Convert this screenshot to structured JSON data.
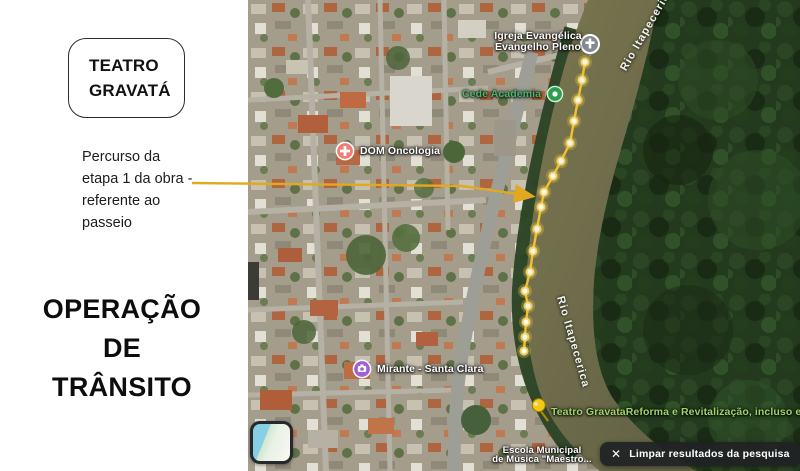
{
  "slide": {
    "badge_label": "TEATRO GRAVATÁ",
    "note_lines": [
      "Percurso da",
      "etapa 1 da obra -",
      "referente ao",
      "passeio"
    ],
    "title_lines": [
      "OPERAÇÃO",
      "DE",
      "TRÂNSITO"
    ]
  },
  "map": {
    "poi": {
      "igreja": {
        "line1": "Igreja Evangélica",
        "line2": "Evangelho Pleno"
      },
      "academia": {
        "label": "Cede Academia"
      },
      "oncologia": {
        "label": "DOM Oncologia"
      },
      "rio_top": {
        "label": "Rio Itapecerica"
      },
      "rio_mid": {
        "label": "Rio Itapecerica"
      },
      "mirante": {
        "label": "Mirante - Santa Clara"
      },
      "teatro_obra": {
        "label": "Teatro GravataReforma e Revitalização, incluso entorno"
      },
      "escola": {
        "line1": "Escola Municipal",
        "line2": "de Música \"Maestro..."
      }
    },
    "route": {
      "name": "percurso-etapa-1",
      "points": [
        [
          337,
          62
        ],
        [
          334,
          80
        ],
        [
          330,
          100
        ],
        [
          326,
          121
        ],
        [
          322,
          143
        ],
        [
          313,
          161
        ],
        [
          305,
          176
        ],
        [
          296,
          192
        ],
        [
          293,
          207
        ],
        [
          289,
          229
        ],
        [
          285,
          251
        ],
        [
          282,
          272
        ],
        [
          277,
          291
        ],
        [
          280,
          306
        ],
        [
          278,
          322
        ],
        [
          277,
          337
        ],
        [
          276,
          351
        ]
      ]
    },
    "clear_button": {
      "icon": "✕",
      "label": "Limpar resultados da pesquisa"
    },
    "colors": {
      "route_yellow": "#f2c12e",
      "arrow_gold": "#e2a81f",
      "academia_green": "#49b86a",
      "teatro_green": "#9fd468",
      "oncologia_red": "#ee7f76",
      "mirante_purple": "#a05fd3",
      "church_gray": "#858b94",
      "button_bg": "#202124"
    }
  }
}
